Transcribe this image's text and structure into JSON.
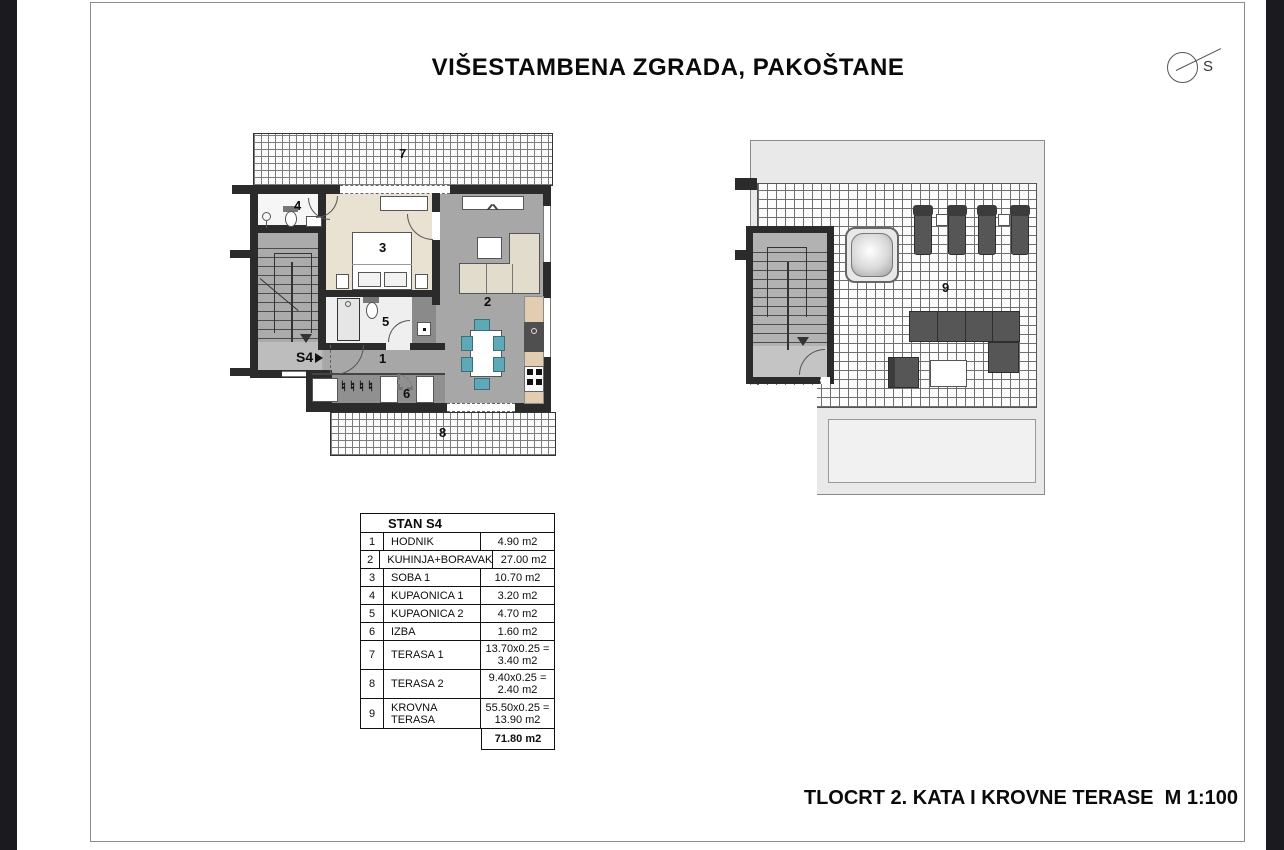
{
  "window": {
    "title": "VIŠESTAMBENA ZGRADA, PAKOŠTANE",
    "caption": "TLOCRT 2. KATA I KROVNE TERASE  M 1:100",
    "north_label": "S"
  },
  "plans": {
    "left": {
      "entrance_label": "S4",
      "rooms": {
        "hodnik": "1",
        "kuhinja_boravak": "2",
        "soba": "3",
        "kupaonica_1": "4",
        "kupaonica_2": "5",
        "izba": "6",
        "terasa_1": "7",
        "terasa_2": "8"
      }
    },
    "right": {
      "krovna_terasa": "9"
    }
  },
  "table": {
    "title": "STAN S4",
    "rows": [
      {
        "num": "1",
        "name": "HODNIK",
        "value": "4.90 m2",
        "value2": ""
      },
      {
        "num": "2",
        "name": "KUHINJA+BORAVAK",
        "value": "27.00 m2",
        "value2": ""
      },
      {
        "num": "3",
        "name": "SOBA 1",
        "value": "10.70 m2",
        "value2": ""
      },
      {
        "num": "4",
        "name": "KUPAONICA 1",
        "value": "3.20 m2",
        "value2": ""
      },
      {
        "num": "5",
        "name": "KUPAONICA 2",
        "value": "4.70 m2",
        "value2": ""
      },
      {
        "num": "6",
        "name": "IZBA",
        "value": "1.60 m2",
        "value2": ""
      },
      {
        "num": "7",
        "name": "TERASA 1",
        "value": "13.70x0.25 =",
        "value2": "3.40 m2"
      },
      {
        "num": "8",
        "name": "TERASA 2",
        "value": "9.40x0.25 =",
        "value2": "2.40 m2"
      },
      {
        "num": "9",
        "name": "KROVNA TERASA",
        "value": "55.50x0.25 =",
        "value2": "13.90 m2"
      }
    ],
    "total": "71.80 m2"
  },
  "colors": {
    "wall": "#2b2b2b",
    "floor_living": "#a7a7a7",
    "floor_bedroom": "#e9e1d2",
    "chair": "#5fa8b5",
    "dark_furniture": "#565656",
    "sheet_border": "#8c8c8c",
    "side_bar": "#1b1b1f"
  }
}
